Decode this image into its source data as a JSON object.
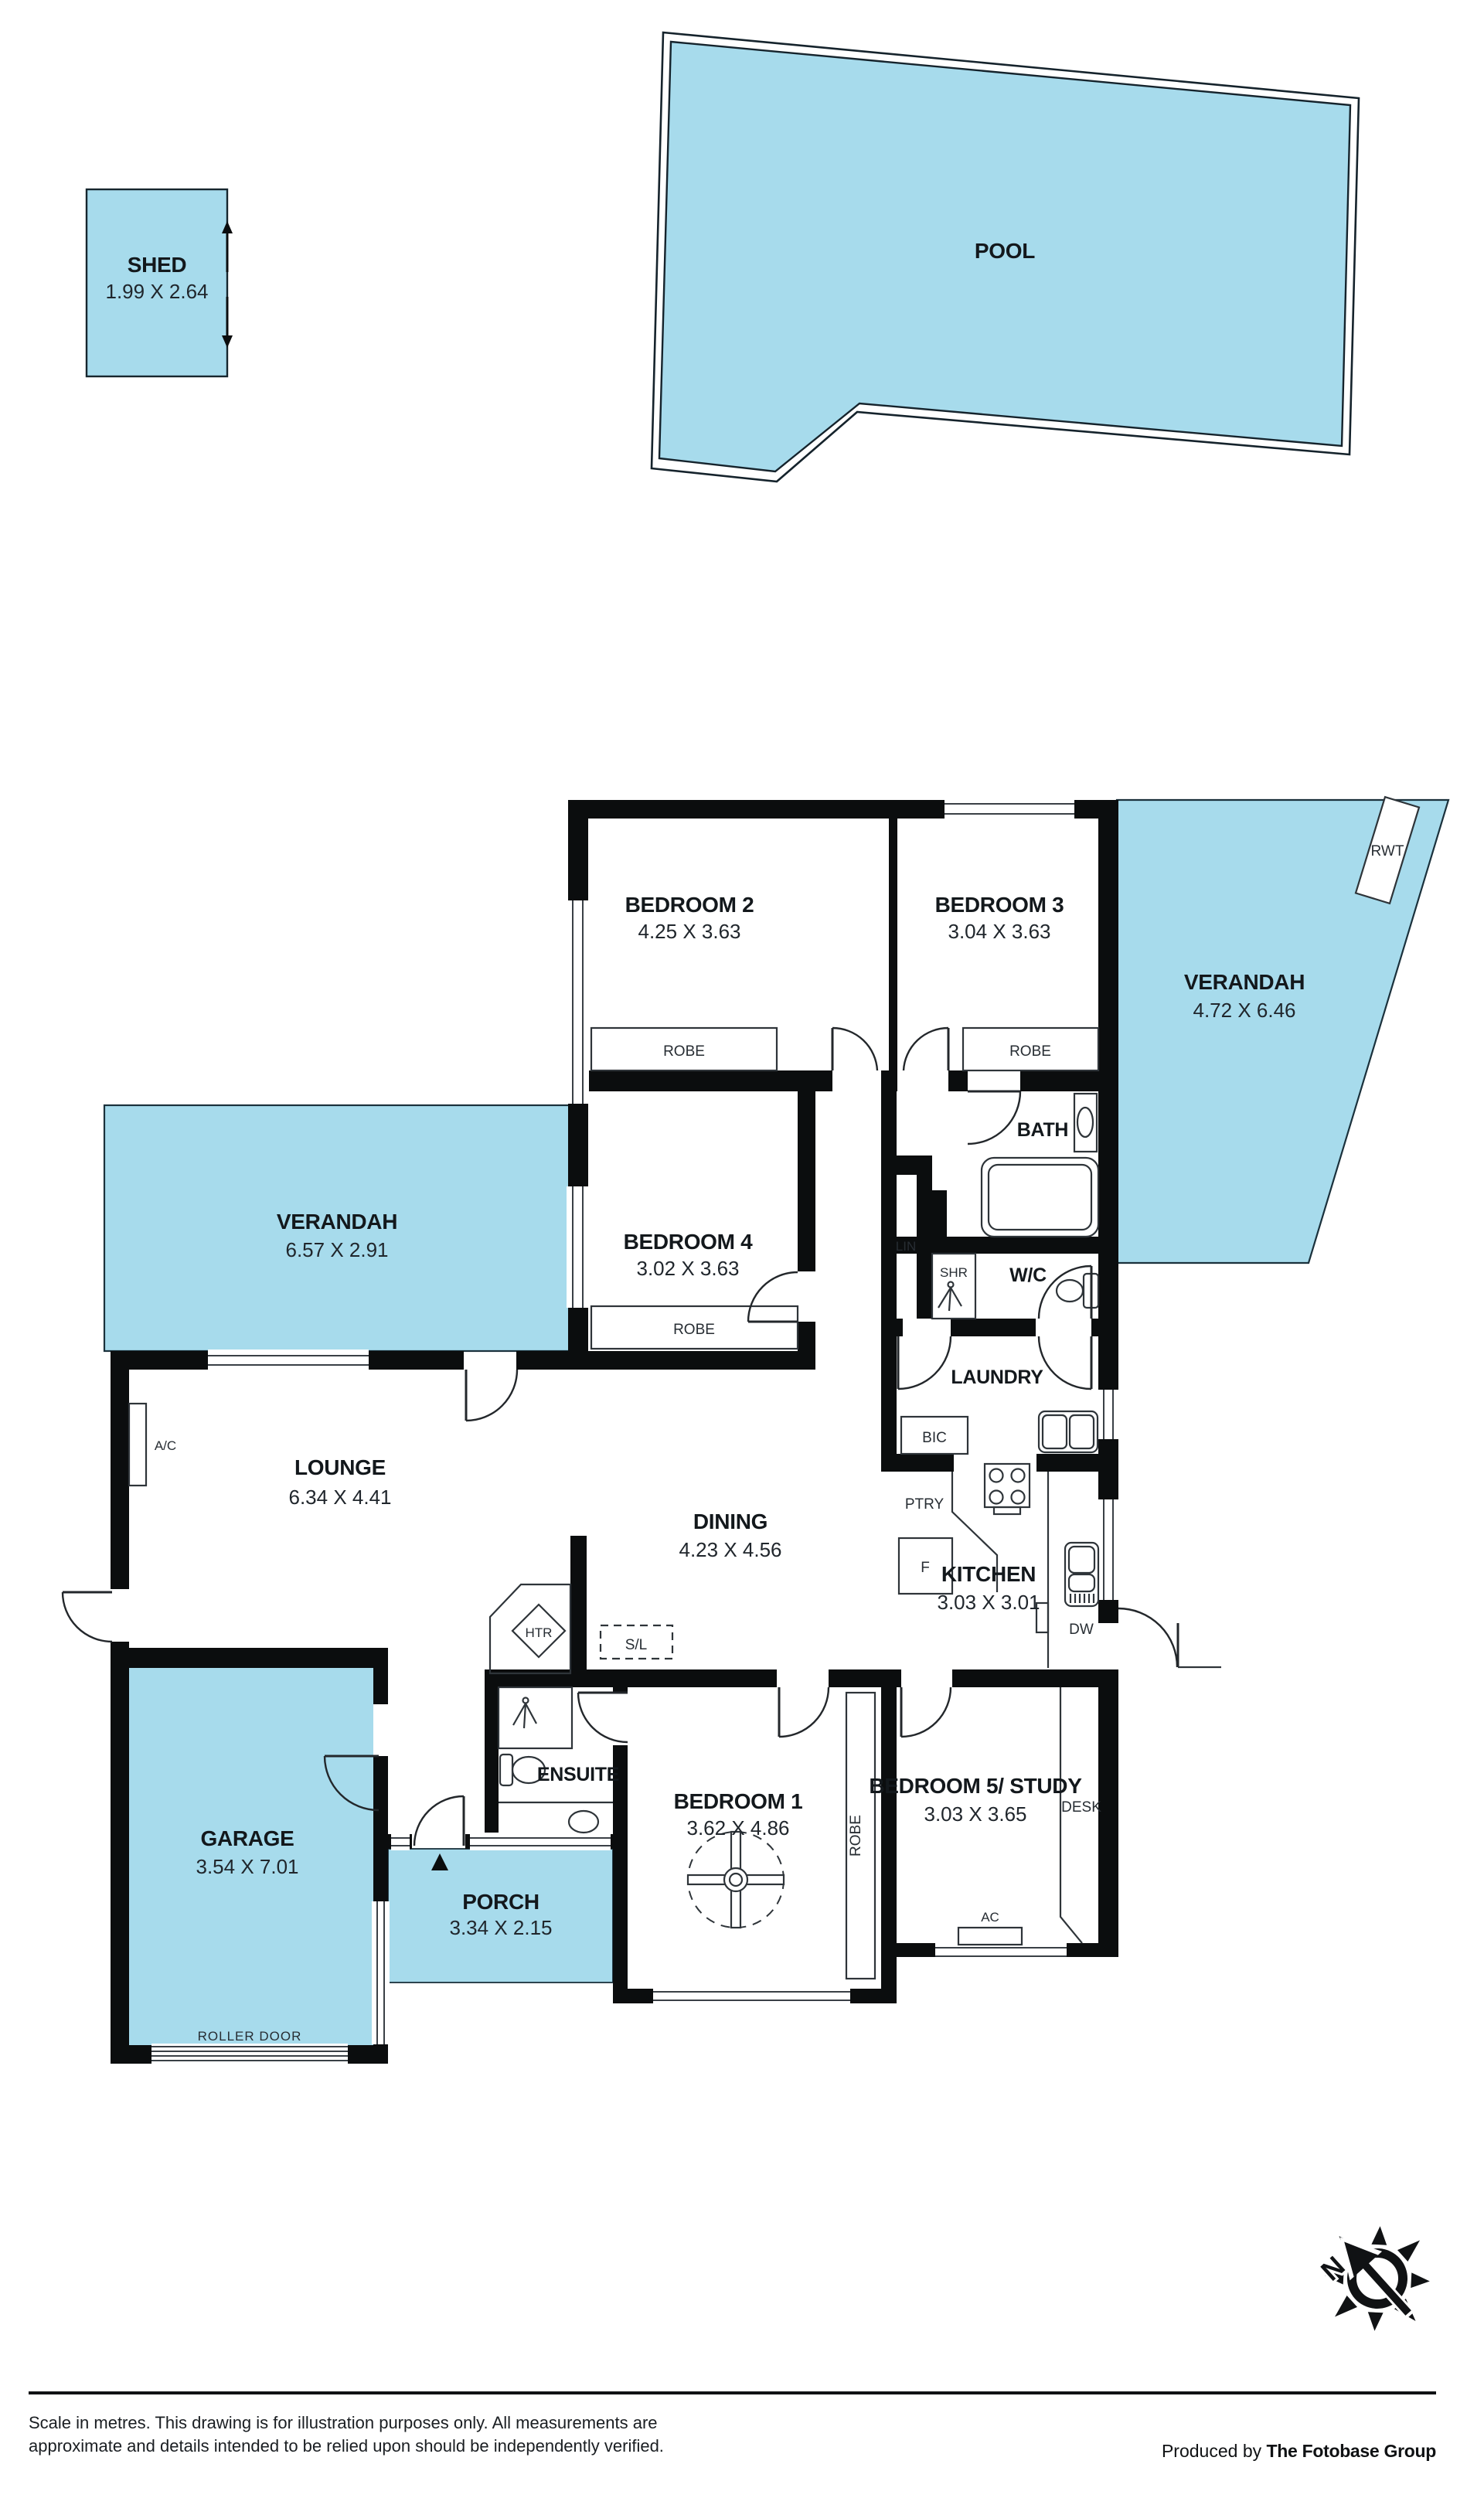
{
  "outbuildings": {
    "shed": {
      "name": "SHED",
      "dims": "1.99 X 2.64"
    },
    "pool": {
      "name": "POOL"
    }
  },
  "rooms": {
    "bedroom1": {
      "name": "BEDROOM 1",
      "dims": "3.62 X 4.86"
    },
    "bedroom2": {
      "name": "BEDROOM 2",
      "dims": "4.25 X 3.63"
    },
    "bedroom3": {
      "name": "BEDROOM 3",
      "dims": "3.04 X 3.63"
    },
    "bedroom4": {
      "name": "BEDROOM 4",
      "dims": "3.02 X 3.63"
    },
    "bedroom5": {
      "name": "BEDROOM 5/ STUDY",
      "dims": "3.03 X 3.65"
    },
    "lounge": {
      "name": "LOUNGE",
      "dims": "6.34 X 4.41"
    },
    "dining": {
      "name": "DINING",
      "dims": "4.23 X 4.56"
    },
    "kitchen": {
      "name": "KITCHEN",
      "dims": "3.03 X 3.01"
    },
    "garage": {
      "name": "GARAGE",
      "dims": "3.54 X 7.01"
    },
    "porch": {
      "name": "PORCH",
      "dims": "3.34 X 2.15"
    },
    "verandah_left": {
      "name": "VERANDAH",
      "dims": "6.57 X 2.91"
    },
    "verandah_right": {
      "name": "VERANDAH",
      "dims": "4.72 X 6.46"
    },
    "bath": {
      "name": "BATH"
    },
    "laundry": {
      "name": "LAUNDRY"
    },
    "ensuite": {
      "name": "ENSUITE"
    },
    "wc": {
      "name": "W/C"
    }
  },
  "labels": {
    "robe": "ROBE",
    "lin": "LIN",
    "shr": "SHR",
    "bic": "BIC",
    "ptry": "PTRY",
    "fridge": "F",
    "dw": "DW",
    "htr": "HTR",
    "sl": "S/L",
    "ac_lounge": "A/C",
    "ac_bed5": "AC",
    "desk": "DESK",
    "rwt": "RWT",
    "roller_door": "ROLLER DOOR",
    "north": "N"
  },
  "footer": {
    "line1": "Scale in metres. This drawing is for illustration purposes only. All measurements are",
    "line2": "approximate and details intended to be relied upon should be independently verified.",
    "credit_prefix": "Produced by ",
    "credit_brand": "The Fotobase Group"
  }
}
